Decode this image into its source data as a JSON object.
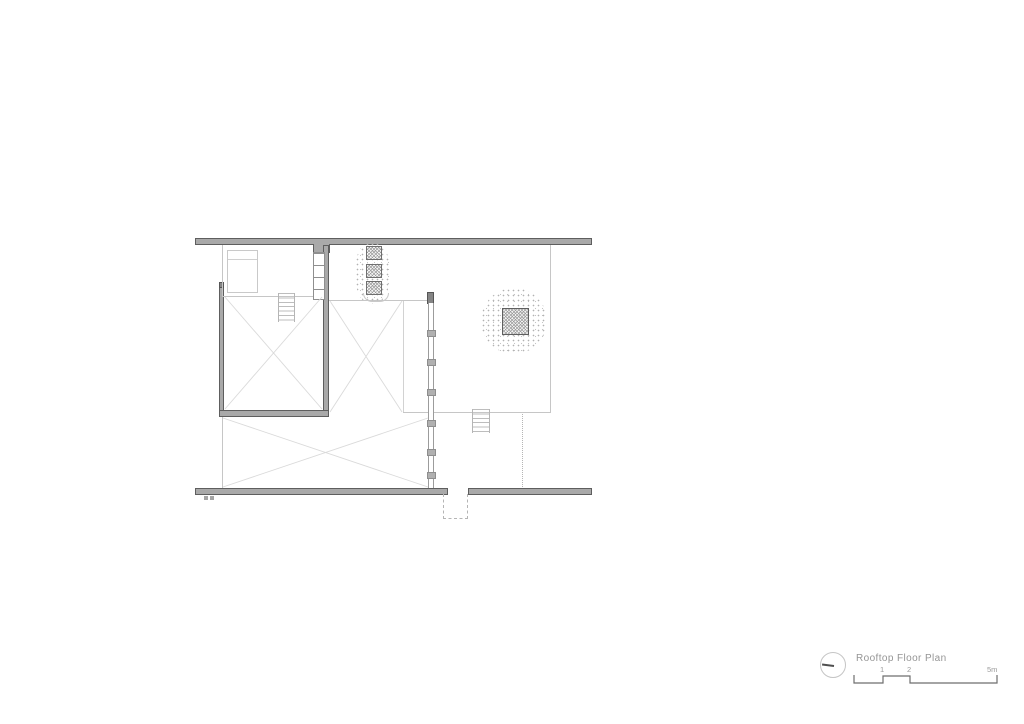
{
  "title_block": {
    "title": "Rooftop Floor Plan",
    "scale_labels": [
      "1",
      "2",
      "5m"
    ],
    "north_marker": "circle-with-bearing-line"
  },
  "colors": {
    "wall_fill": "#a9a9a9",
    "wall_outline": "#5e5e5e",
    "thin_line": "#c6c6c6",
    "diagonal_line": "#dadada",
    "hatch": "#9a9a9a",
    "foliage_dot": "#b2b2b2",
    "text": "#959595",
    "scale_bar": "#6e6e6e"
  }
}
